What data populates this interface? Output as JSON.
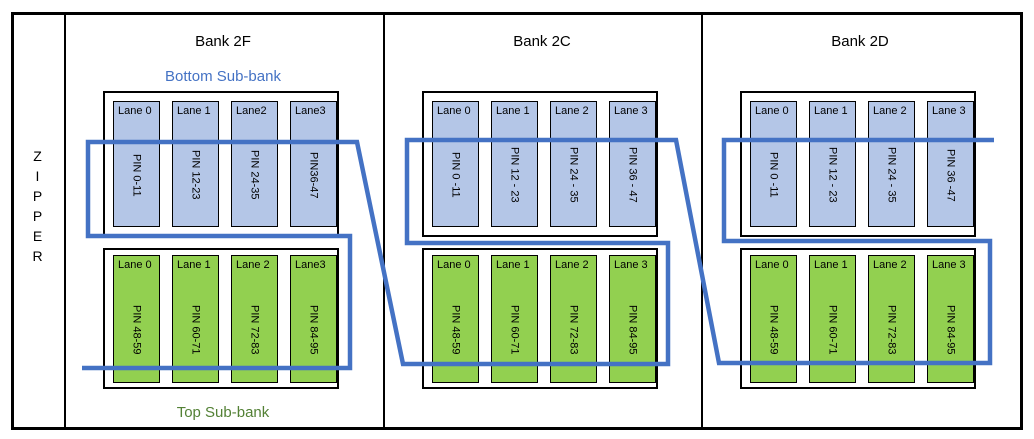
{
  "zipper": {
    "text": "ZIPPER",
    "letters": [
      "Z",
      "I",
      "P",
      "P",
      "E",
      "R"
    ]
  },
  "labels": {
    "bottom_subbank": "Bottom Sub-bank",
    "top_subbank": "Top Sub-bank"
  },
  "colors": {
    "zipper_line": "#4472C4",
    "lane_blue": "#B4C6E7",
    "lane_green": "#92D050",
    "bottom_label": "#4472C4",
    "top_label": "#538135"
  },
  "banks": [
    {
      "title": "Bank 2F",
      "bottom_lanes": [
        {
          "label": "Lane 0",
          "pin": "PIN 0-11"
        },
        {
          "label": "Lane 1",
          "pin": "PIN 12-23"
        },
        {
          "label": "Lane2",
          "pin": "PIN 24-35"
        },
        {
          "label": "Lane3",
          "pin": "PIN36-47"
        }
      ],
      "top_lanes": [
        {
          "label": "Lane 0",
          "pin": "PIN 48-59"
        },
        {
          "label": "Lane 1",
          "pin": "PIN 60-71"
        },
        {
          "label": "Lane 2",
          "pin": "PIN 72-83"
        },
        {
          "label": "Lane3",
          "pin": "PIN 84-95"
        }
      ]
    },
    {
      "title": "Bank 2C",
      "bottom_lanes": [
        {
          "label": "Lane 0",
          "pin": "PIN 0 -11"
        },
        {
          "label": "Lane 1",
          "pin": "PIN 12 - 23"
        },
        {
          "label": "Lane 2",
          "pin": "PIN 24 - 35"
        },
        {
          "label": "Lane 3",
          "pin": "PIN 36 - 47"
        }
      ],
      "top_lanes": [
        {
          "label": "Lane 0",
          "pin": "PIN 48-59"
        },
        {
          "label": "Lane 1",
          "pin": "PIN 60-71"
        },
        {
          "label": "Lane 2",
          "pin": "PIN 72-83"
        },
        {
          "label": "Lane 3",
          "pin": "PIN 84-95"
        }
      ]
    },
    {
      "title": "Bank 2D",
      "bottom_lanes": [
        {
          "label": "Lane 0",
          "pin": "PIN 0 -11"
        },
        {
          "label": "Lane 1",
          "pin": "PIN 12 - 23"
        },
        {
          "label": "Lane 2",
          "pin": "PIN 24 - 35"
        },
        {
          "label": "Lane 3",
          "pin": "PIN 36 -47"
        }
      ],
      "top_lanes": [
        {
          "label": "Lane 0",
          "pin": "PIN 48-59"
        },
        {
          "label": "Lane 1",
          "pin": "PIN 60-71"
        },
        {
          "label": "Lane 2",
          "pin": "PIN 72-83"
        },
        {
          "label": "Lane 3",
          "pin": "PIN 84-95"
        }
      ]
    }
  ]
}
